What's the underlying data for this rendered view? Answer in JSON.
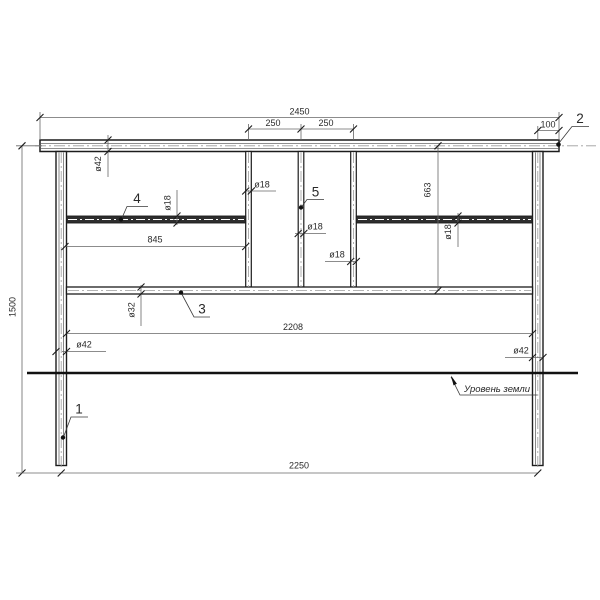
{
  "parts": {
    "post": "1",
    "top_rail": "2",
    "mid_rail": "3",
    "left_bar": "4",
    "center_bar": "5"
  },
  "dims": {
    "overall_width": "2450",
    "left_segment": "250",
    "right_segment": "250",
    "end_overhang": "100",
    "total_height": "1500",
    "upper_panel_height": "663",
    "left_bar_length": "845",
    "inner_span": "2208",
    "post_spacing": "2250"
  },
  "callouts": {
    "top_rail_dia": "ø42",
    "left_bar_dia": "ø18",
    "vert1_dia": "ø18",
    "vert2_dia": "ø18",
    "vert3_dia": "ø18",
    "right_bar_dia": "ø18",
    "mid_rail_dia": "ø32",
    "left_post_dia": "ø42",
    "right_post_dia": "ø42"
  },
  "notes": {
    "ground_level": "Уровень земли"
  },
  "colors": {
    "line": "#1c1c1c",
    "centerline": "#9c9c9c",
    "dim_line": "#666666",
    "text": "#2a2a2a",
    "background": "#ffffff"
  }
}
